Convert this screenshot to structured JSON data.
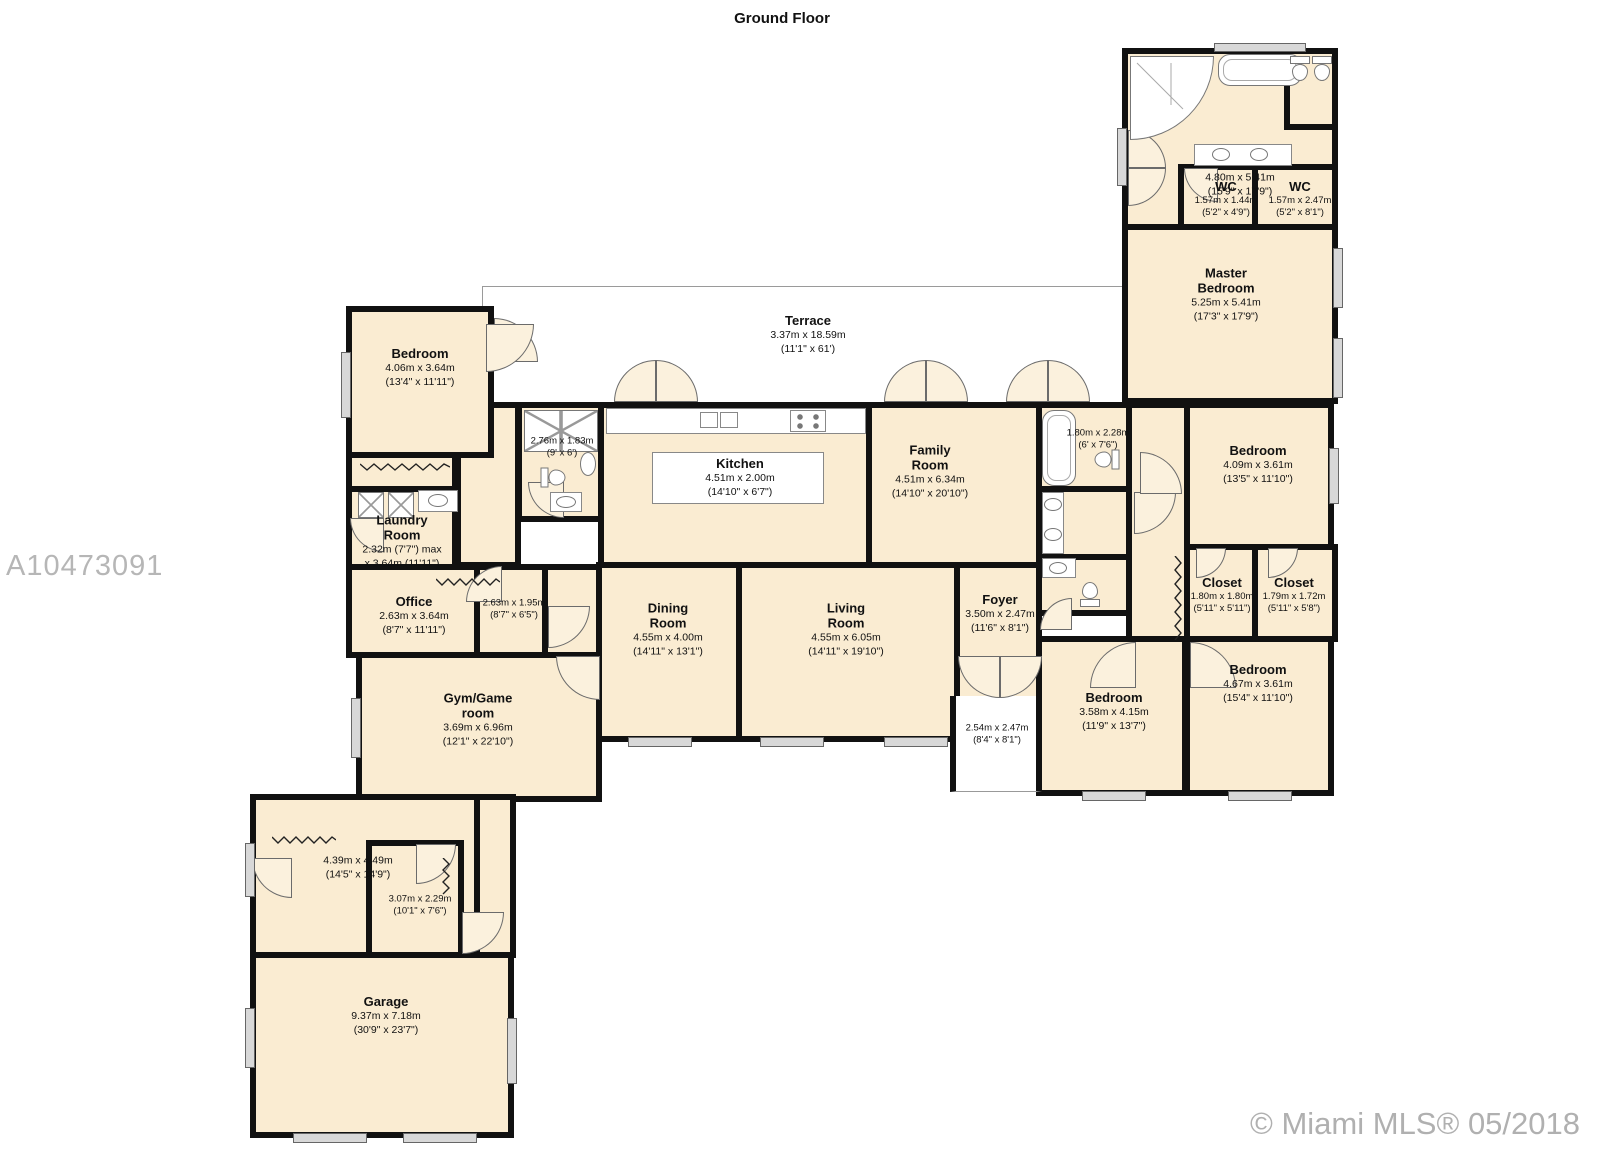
{
  "title": "Ground Floor",
  "watermark": "A10473091",
  "copyright": "© Miami MLS® 05/2018",
  "colors": {
    "room_fill": "#faecd2",
    "wall": "#111111",
    "terrace_fill": "#ffffff",
    "window_fill": "#d8d8d8",
    "watermark_gray": "#b6b6b6",
    "copyright_gray": "#b0b0b0"
  },
  "rooms": [
    {
      "name": "",
      "metric": "4.80m x 5.41m",
      "imperial": "(15'9\" x 17'9\")"
    },
    {
      "name": "WC",
      "metric": "1.57m x 1.44m",
      "imperial": "(5'2\" x 4'9\")"
    },
    {
      "name": "WC",
      "metric": "1.57m x 2.47m",
      "imperial": "(5'2\" x 8'1\")"
    },
    {
      "name": "Master\nBedroom",
      "metric": "5.25m x 5.41m",
      "imperial": "(17'3\" x 17'9\")"
    },
    {
      "name": "Terrace",
      "metric": "3.37m x 18.59m",
      "imperial": "(11'1\" x 61')"
    },
    {
      "name": "Bedroom",
      "metric": "4.06m x 3.64m",
      "imperial": "(13'4\" x 11'11\")"
    },
    {
      "name": "",
      "metric": "2.76m x 1.83m",
      "imperial": "(9' x 6')"
    },
    {
      "name": "Kitchen",
      "metric": "4.51m x 2.00m",
      "imperial": "(14'10\" x 6'7\")"
    },
    {
      "name": "Family\nRoom",
      "metric": "4.51m x 6.34m",
      "imperial": "(14'10\" x 20'10\")"
    },
    {
      "name": "",
      "metric": "1.80m x 2.28m",
      "imperial": "(6' x 7'6\")"
    },
    {
      "name": "Bedroom",
      "metric": "4.09m x 3.61m",
      "imperial": "(13'5\" x 11'10\")"
    },
    {
      "name": "Laundry\nRoom",
      "metric": "2.32m (7'7\") max",
      "imperial": "x 3.64m (11'11\")"
    },
    {
      "name": "Office",
      "metric": "2.63m x 3.64m",
      "imperial": "(8'7\" x 11'11\")"
    },
    {
      "name": "",
      "metric": "2.63m x 1.95m",
      "imperial": "(8'7\" x 6'5\")"
    },
    {
      "name": "Dining\nRoom",
      "metric": "4.55m x 4.00m",
      "imperial": "(14'11\" x 13'1\")"
    },
    {
      "name": "Living\nRoom",
      "metric": "4.55m x 6.05m",
      "imperial": "(14'11\" x 19'10\")"
    },
    {
      "name": "Foyer",
      "metric": "3.50m x 2.47m",
      "imperial": "(11'6\" x 8'1\")"
    },
    {
      "name": "Closet",
      "metric": "1.80m x 1.80m",
      "imperial": "(5'11\" x 5'11\")"
    },
    {
      "name": "Closet",
      "metric": "1.79m x 1.72m",
      "imperial": "(5'11\" x 5'8\")"
    },
    {
      "name": "Bedroom",
      "metric": "3.58m x 4.15m",
      "imperial": "(11'9\" x 13'7\")"
    },
    {
      "name": "Bedroom",
      "metric": "4.67m x 3.61m",
      "imperial": "(15'4\" x 11'10\")"
    },
    {
      "name": "",
      "metric": "2.54m x 2.47m",
      "imperial": "(8'4\" x 8'1\")"
    },
    {
      "name": "Gym/Game\nroom",
      "metric": "3.69m x 6.96m",
      "imperial": "(12'1\" x 22'10\")"
    },
    {
      "name": "",
      "metric": "4.39m x 4.49m",
      "imperial": "(14'5\" x 14'9\")"
    },
    {
      "name": "",
      "metric": "3.07m x 2.29m",
      "imperial": "(10'1\" x 7'6\")"
    },
    {
      "name": "Garage",
      "metric": "9.37m x 7.18m",
      "imperial": "(30'9\" x 23'7\")"
    }
  ]
}
